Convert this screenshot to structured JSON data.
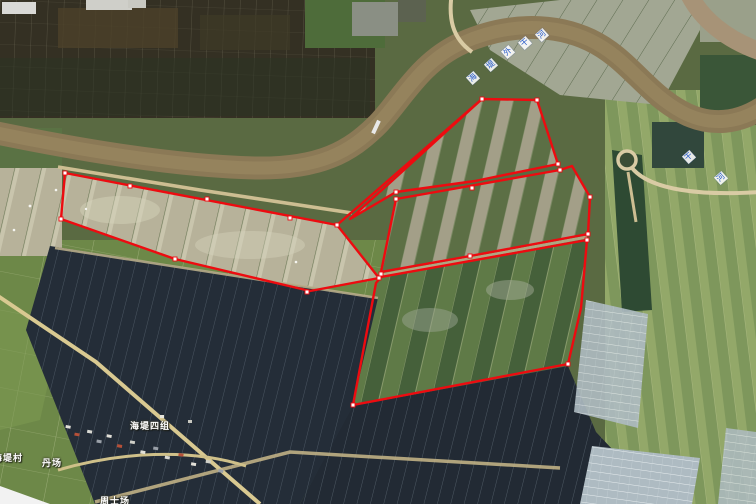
{
  "map": {
    "labels": {
      "village_group": {
        "text": "海堤四组"
      },
      "village_left": {
        "text": "海堤村"
      },
      "hamlet": {
        "text": "丹场"
      },
      "site_bottom": {
        "text": "周士场"
      }
    },
    "river_label": {
      "chars_main": [
        "海",
        "堤",
        "外",
        "干",
        "河"
      ],
      "chars_right": [
        "干",
        "河"
      ]
    },
    "colors": {
      "annotation_red": "#ed0b10",
      "river_label_blue": "#2458c8",
      "river_brown": "#8b7956",
      "solar_dark": "#232b35"
    }
  },
  "annotations": {
    "polygons": [
      {
        "name": "west-pond-parcel",
        "points": [
          [
            65,
            173
          ],
          [
            337,
            225
          ],
          [
            379,
            278
          ],
          [
            310,
            291
          ],
          [
            175,
            259
          ],
          [
            61,
            219
          ]
        ]
      },
      {
        "name": "north-triangle-parcel",
        "points": [
          [
            350,
            219
          ],
          [
            482,
            99
          ],
          [
            537,
            100
          ],
          [
            558,
            164
          ],
          [
            475,
            181
          ],
          [
            396,
            192
          ]
        ]
      },
      {
        "name": "middle-parcel",
        "points": [
          [
            396,
            199
          ],
          [
            560,
            170
          ],
          [
            572,
            166
          ],
          [
            590,
            197
          ],
          [
            588,
            234
          ],
          [
            470,
            256
          ],
          [
            381,
            272
          ]
        ]
      },
      {
        "name": "south-parcel",
        "points": [
          [
            381,
            277
          ],
          [
            587,
            240
          ],
          [
            581,
            308
          ],
          [
            568,
            364
          ],
          [
            353,
            405
          ],
          [
            376,
            283
          ]
        ]
      }
    ],
    "extra_edges": [
      [
        [
          337,
          225
        ],
        [
          482,
          99
        ]
      ]
    ],
    "vertex_markers": [
      [
        65,
        173
      ],
      [
        61,
        219
      ],
      [
        130,
        186
      ],
      [
        207,
        199
      ],
      [
        290,
        218
      ],
      [
        337,
        225
      ],
      [
        379,
        278
      ],
      [
        307,
        292
      ],
      [
        175,
        259
      ],
      [
        482,
        99
      ],
      [
        537,
        100
      ],
      [
        558,
        164
      ],
      [
        396,
        192
      ],
      [
        396,
        199
      ],
      [
        560,
        170
      ],
      [
        590,
        197
      ],
      [
        588,
        234
      ],
      [
        470,
        256
      ],
      [
        472,
        188
      ],
      [
        381,
        274
      ],
      [
        587,
        240
      ],
      [
        568,
        364
      ],
      [
        353,
        405
      ]
    ]
  }
}
